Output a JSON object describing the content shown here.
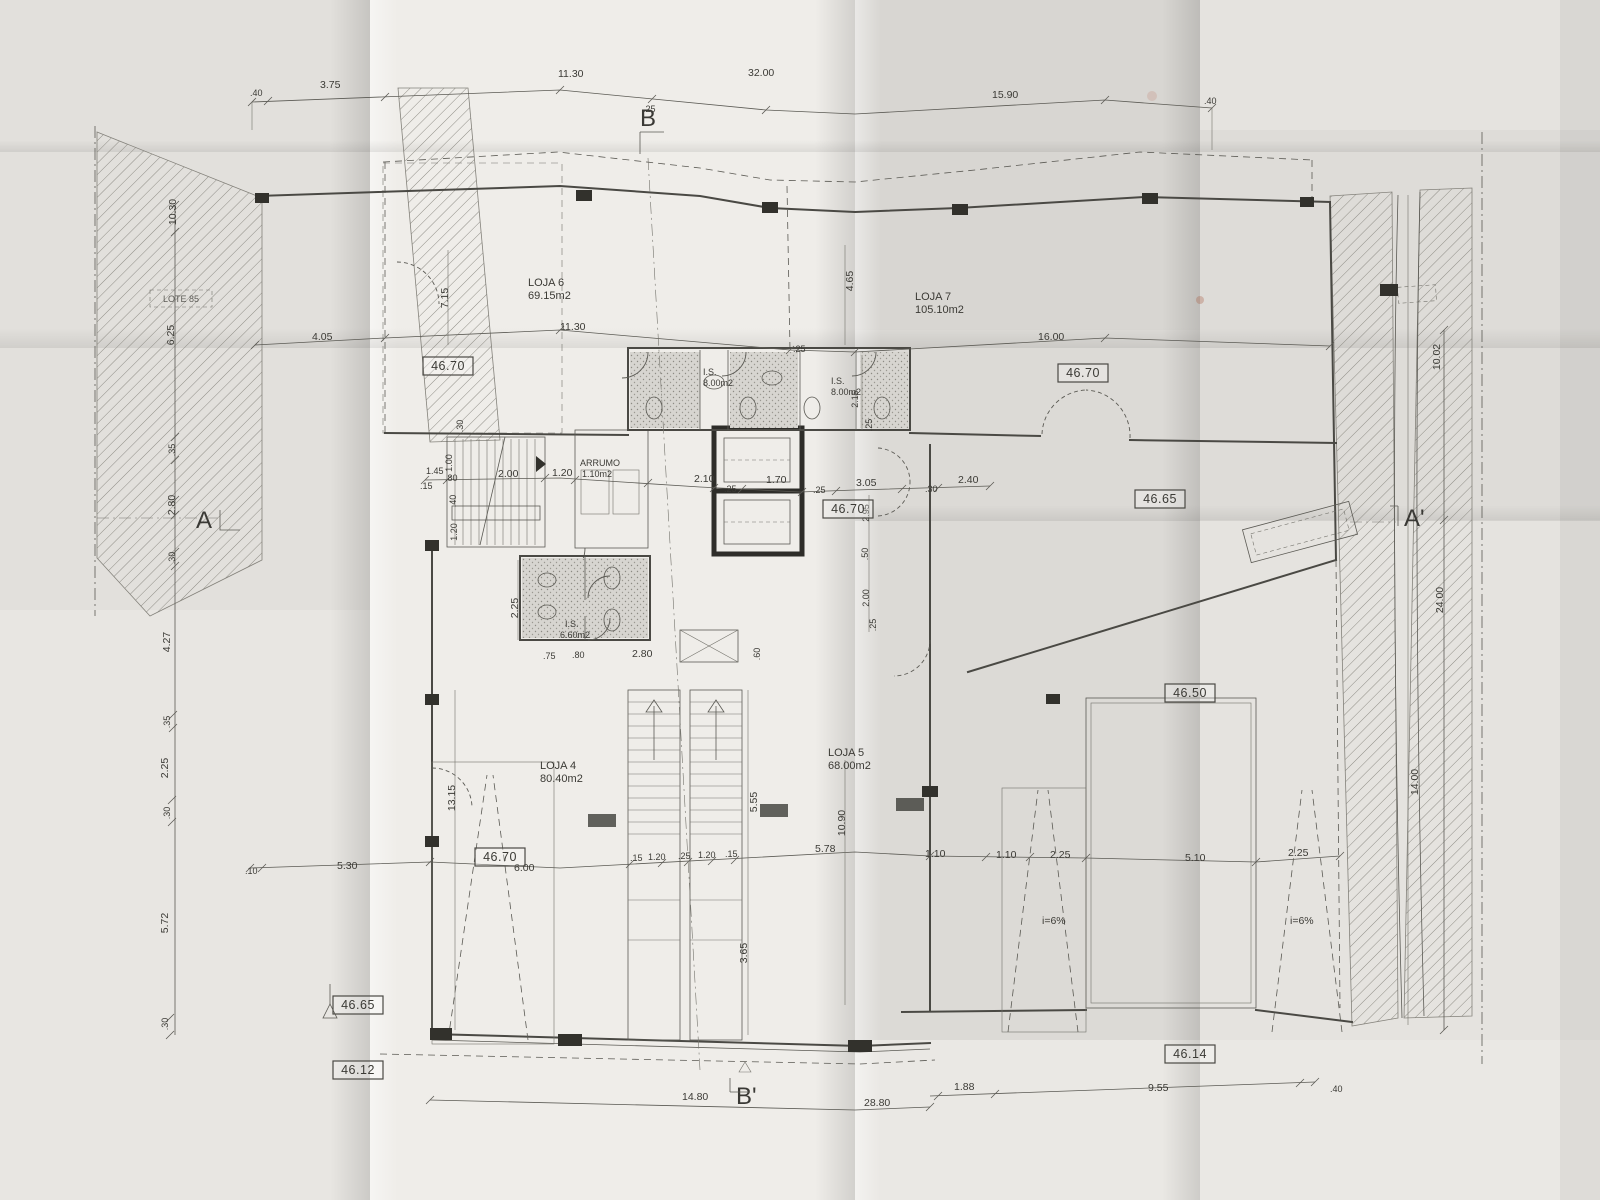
{
  "plan": {
    "rooms": [
      {
        "name": "LOJA 6",
        "area": "69.15m2"
      },
      {
        "name": "LOJA 7",
        "area": "105.10m2"
      },
      {
        "name": "LOJA 4",
        "area": "80.40m2"
      },
      {
        "name": "LOJA 5",
        "area": "68.00m2"
      },
      {
        "name": "I.S.",
        "area": "8.00m2"
      },
      {
        "name": "I.S.",
        "area": "8.00m2"
      },
      {
        "name": "I.S.",
        "area": "6.60m2"
      },
      {
        "name": "ARRUMO",
        "area": "1.10m2"
      }
    ],
    "levels": [
      "46.70",
      "46.70",
      "46.70",
      "46.65",
      "46.50",
      "46.70",
      "46.65",
      "46.12",
      "46.14"
    ],
    "sections": {
      "b": "B",
      "b_prime": "B'",
      "a": "A",
      "a_prime": "A'"
    },
    "site_label": "LOTE 85",
    "ramp_slopes": [
      "i=6%",
      "i=6%"
    ]
  },
  "dims_top": [
    ".40",
    "3.75",
    "11.30",
    "32.00",
    ".25",
    "15.90",
    ".40"
  ],
  "dims_left": [
    "10.30",
    "6.25",
    ".35",
    "2.80",
    ".30",
    "4.27",
    ".35",
    "2.25",
    ".30",
    "5.72",
    ".30"
  ],
  "dims_right": [
    "10.02",
    "24.00",
    "14.00"
  ],
  "dims_bottom": [
    "14.80",
    "28.80",
    "1.88",
    "9.55",
    ".40"
  ],
  "dims_upper": [
    "4.05",
    "11.30",
    "16.00",
    "7.15",
    "4.65",
    "2.15",
    ".25",
    ".25"
  ],
  "dims_core": [
    ".80",
    "1.45",
    ".15",
    "1.00",
    "2.00",
    "1.20",
    ".30",
    ".40",
    "1.20",
    "2.10",
    ".25",
    "1.70",
    ".25",
    "3.05",
    ".30",
    "2.40",
    "2.95",
    ".50",
    "2.00",
    ".25"
  ],
  "dims_mid": [
    "2.25",
    ".75",
    ".80",
    "2.80",
    ".60"
  ],
  "dims_lower": [
    "13.15",
    "5.55",
    "10.90",
    "3.65",
    ".10",
    "5.30",
    "6.00",
    ".15",
    "1.20",
    ".25",
    "1.20",
    ".15",
    "5.78",
    "1.10",
    "1.10",
    "2.25",
    "5.10",
    "2.25"
  ]
}
